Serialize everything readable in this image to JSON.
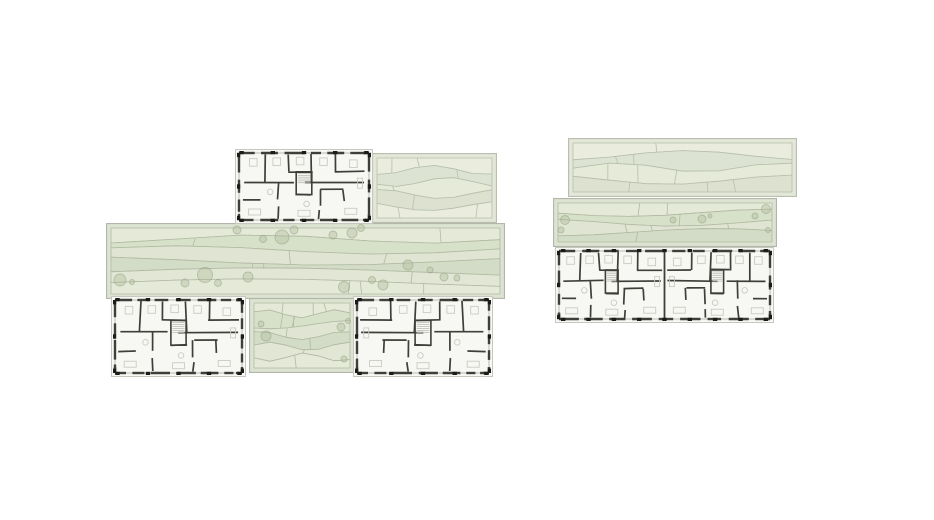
{
  "meta": {
    "description": "Architectural roof and floor plan drawing with two building clusters (green roof bands with trees, detailed apartment floor plans)",
    "background": "#ffffff",
    "width": 934,
    "height": 520
  },
  "palette": {
    "plan": {
      "bg": "#f7f7f4",
      "roof_edge": "#c6c8c0",
      "wall": "#3e3f39",
      "glazing": "#b3b4ae",
      "furniture": "#c9cbc3",
      "tick": "#1b1b19",
      "stair": "#babcb4"
    },
    "roof": {
      "green": {
        "base": "#dde3d1",
        "fills": [
          "#e5e9d8",
          "#d7e0c9",
          "#dfe5d2",
          "#d3dcc6",
          "#e2e6d5"
        ],
        "line": "#b1b9a3",
        "border": "#b2b8a9"
      },
      "pale": {
        "base": "#e3e7d8",
        "fills": [
          "#eaecdd",
          "#dde3d2",
          "#e6ead9",
          "#dce2cf"
        ],
        "line": "#b8bfac",
        "border": "#b9beae"
      },
      "tree_fill": "#a9b896",
      "tree_stroke": "#93a383"
    }
  },
  "blocks": [
    {
      "name": "left-roof-panel-upper-right",
      "type": "roof",
      "variant": "pale",
      "x": 372,
      "y": 153,
      "w": 125,
      "h": 70,
      "seed": 5,
      "trees": []
    },
    {
      "name": "left-roof-band-main",
      "type": "roof",
      "variant": "green",
      "x": 106,
      "y": 223,
      "w": 399,
      "h": 76,
      "seed": 8,
      "trees": [
        [
          14,
          57,
          6
        ],
        [
          26,
          59,
          2.5
        ],
        [
          79,
          60,
          4
        ],
        [
          99,
          52,
          7.5
        ],
        [
          112,
          60,
          3.5
        ],
        [
          131,
          7,
          4
        ],
        [
          142,
          54,
          5
        ],
        [
          157,
          16,
          3.5
        ],
        [
          176,
          14,
          7
        ],
        [
          188,
          7,
          4
        ],
        [
          227,
          12,
          4
        ],
        [
          246,
          10,
          5
        ],
        [
          255,
          5,
          3.5
        ],
        [
          238,
          64,
          5.5
        ],
        [
          266,
          57,
          3.5
        ],
        [
          277,
          62,
          5
        ],
        [
          302,
          42,
          5
        ],
        [
          324,
          47,
          3
        ],
        [
          338,
          54,
          4
        ],
        [
          351,
          55,
          3
        ]
      ]
    },
    {
      "name": "left-roof-extension-center",
      "type": "roof",
      "variant": "green",
      "x": 249,
      "y": 298,
      "w": 106,
      "h": 75,
      "seed": 12,
      "trees": [
        [
          12,
          26,
          3
        ],
        [
          17,
          38,
          5
        ],
        [
          92,
          29,
          4
        ],
        [
          99,
          23,
          2.5
        ],
        [
          95,
          61,
          3
        ]
      ]
    },
    {
      "name": "right-roof-band-upper",
      "type": "roof",
      "variant": "pale",
      "x": 568,
      "y": 138,
      "w": 229,
      "h": 59,
      "seed": 21,
      "trees": []
    },
    {
      "name": "right-roof-band-lower",
      "type": "roof",
      "variant": "green",
      "x": 553,
      "y": 198,
      "w": 224,
      "h": 49,
      "seed": 27,
      "trees": [
        [
          12,
          22,
          4.5
        ],
        [
          8,
          32,
          3
        ],
        [
          120,
          22,
          3
        ],
        [
          149,
          21,
          4
        ],
        [
          157,
          18,
          2
        ],
        [
          202,
          18,
          3
        ],
        [
          213,
          11,
          4.5
        ],
        [
          215,
          32,
          2.5
        ]
      ]
    },
    {
      "name": "left-floor-plan-top",
      "type": "plan",
      "x": 235,
      "y": 149,
      "w": 138,
      "h": 75,
      "seed": 11,
      "modules": 1,
      "mirror": false
    },
    {
      "name": "left-floor-plan-bottom-left",
      "type": "plan",
      "x": 111,
      "y": 296,
      "w": 135,
      "h": 81,
      "seed": 22,
      "modules": 1,
      "mirror": false
    },
    {
      "name": "left-floor-plan-bottom-right",
      "type": "plan",
      "x": 353,
      "y": 296,
      "w": 140,
      "h": 81,
      "seed": 22,
      "modules": 1,
      "mirror": true
    },
    {
      "name": "right-floor-plan",
      "type": "plan",
      "x": 555,
      "y": 247,
      "w": 219,
      "h": 76,
      "seed": 33,
      "modules": 2,
      "mirror": false
    }
  ]
}
